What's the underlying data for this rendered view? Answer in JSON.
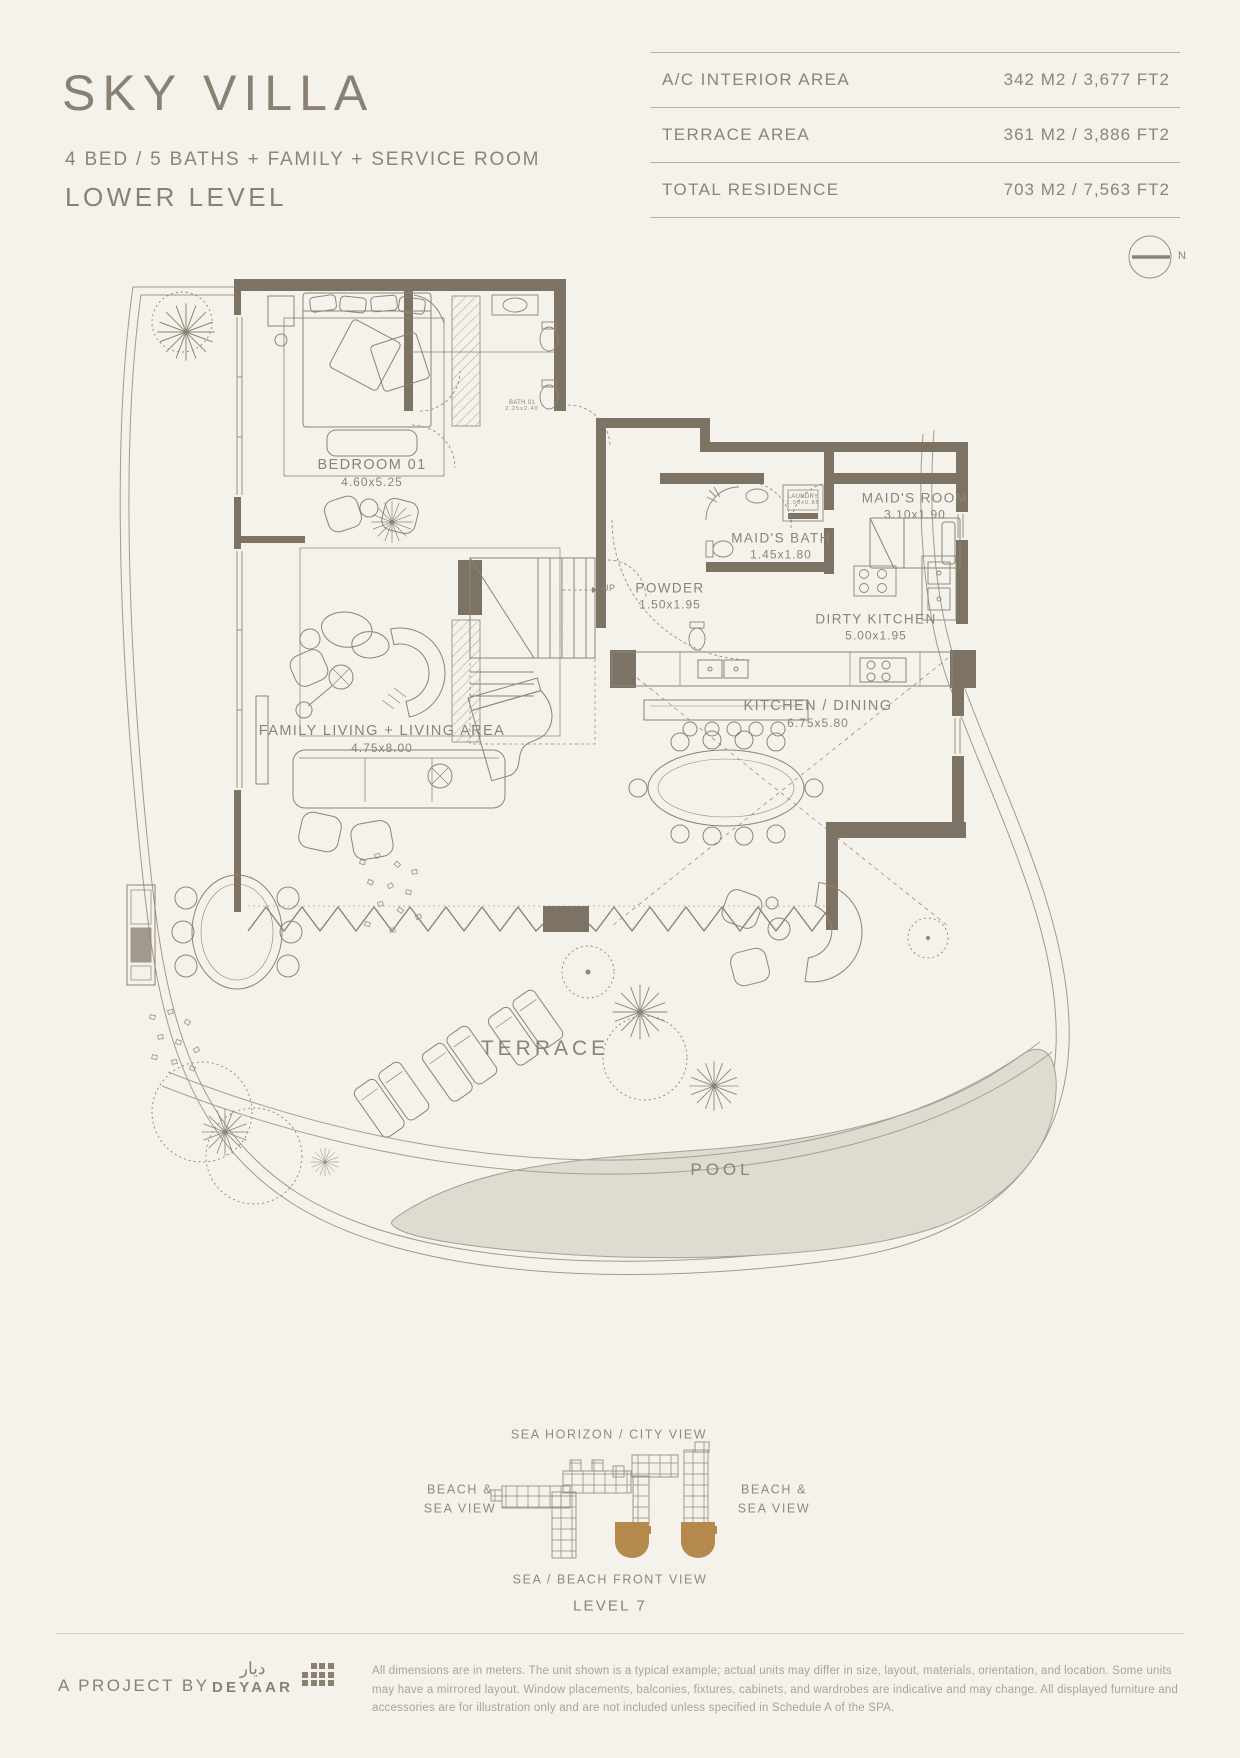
{
  "header": {
    "title": "SKY VILLA",
    "subtitle": "4 BED / 5 BATHS + FAMILY + SERVICE ROOM",
    "level": "LOWER LEVEL",
    "area_table": {
      "rows": [
        {
          "label": "A/C INTERIOR AREA",
          "value": "342 M2 / 3,677 FT2"
        },
        {
          "label": "TERRACE AREA",
          "value": "361 M2 / 3,886 FT2"
        },
        {
          "label": "TOTAL RESIDENCE",
          "value": "703 M2 / 7,563 FT2"
        }
      ]
    },
    "compass": "N"
  },
  "floorplan": {
    "rooms": [
      {
        "name": "BEDROOM 01",
        "size": "4.60x5.25"
      },
      {
        "name": "BATH 01",
        "size": "2.25x2.40"
      },
      {
        "name": "MAID'S BATH",
        "size": "1.45x1.80"
      },
      {
        "name": "MAID'S ROOM",
        "size": "3.10x1.90"
      },
      {
        "name": "LAUNDRY",
        "size": "1.00x0.85"
      },
      {
        "name": "POWDER",
        "size": "1.50x1.95"
      },
      {
        "name": "DIRTY KITCHEN",
        "size": "5.00x1.95"
      },
      {
        "name": "KITCHEN / DINING",
        "size": "6.75x5.80"
      },
      {
        "name": "FAMILY LIVING + LIVING AREA",
        "size": "4.75x8.00"
      }
    ],
    "stair_label": "UP",
    "terrace_label": "TERRACE",
    "pool_label": "POOL"
  },
  "key_plan": {
    "top_label": "SEA HORIZON / CITY VIEW",
    "left_label": "BEACH &\nSEA VIEW",
    "right_label": "BEACH &\nSEA VIEW",
    "bottom_label": "SEA / BEACH FRONT VIEW",
    "level_label": "LEVEL 7",
    "highlight_color": "#b5894b"
  },
  "footer": {
    "project_by": "A PROJECT BY",
    "brand_arabic": "ديار",
    "brand_name": "DEYAAR",
    "disclaimer": "All dimensions are in meters. The unit shown is a typical example; actual units may differ in size, layout, materials, orientation, and location. Some units may have a mirrored layout. Window placements, balconies, fixtures, cabinets, and wardrobes are indicative and may change. All displayed furniture and accessories are for illustration only and are not included unless specified in Schedule A of the SPA."
  },
  "colors": {
    "background": "#f4f2ea",
    "ink": "#8a8172",
    "wall": "#7c7365",
    "pool_fill": "#dedbd0",
    "highlight": "#b5894b"
  }
}
